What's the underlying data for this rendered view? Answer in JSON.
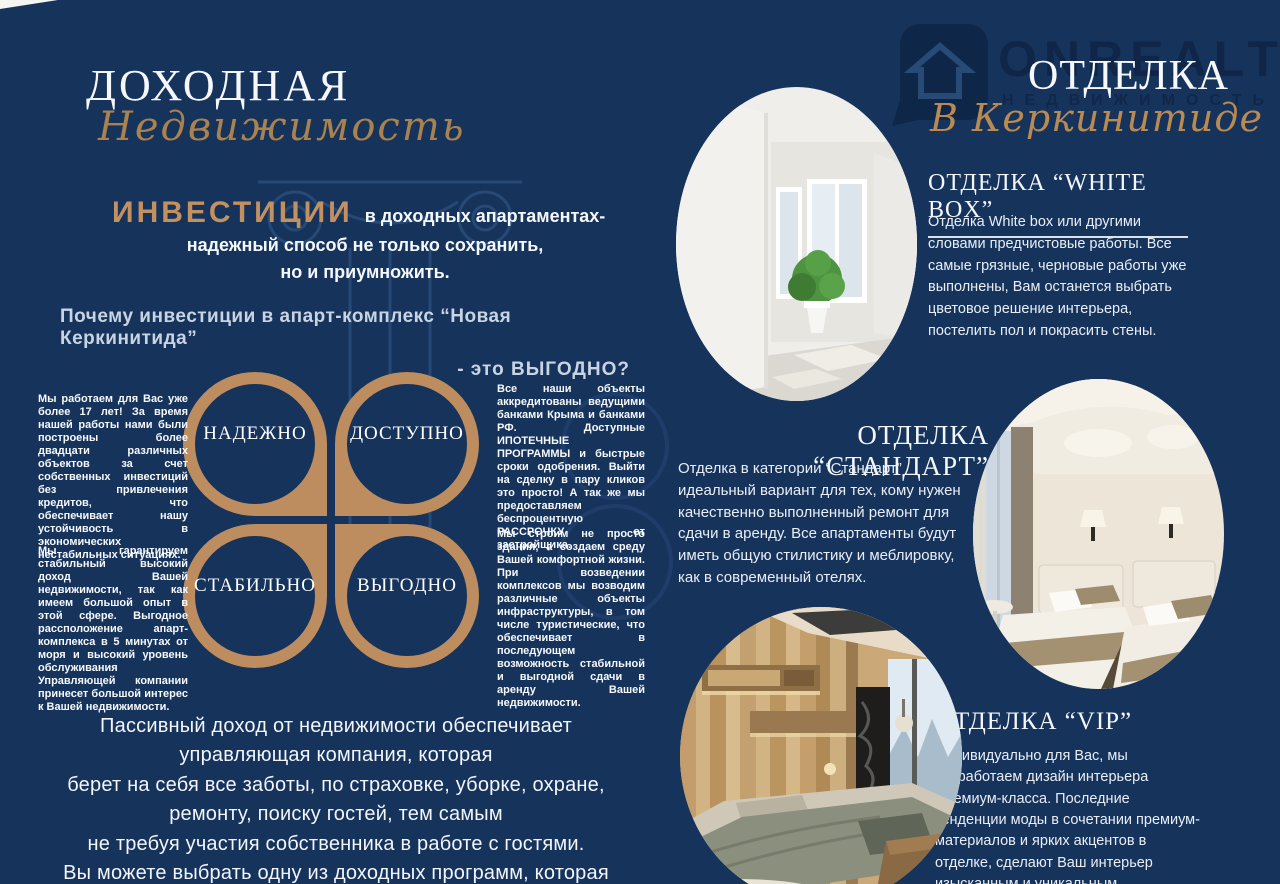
{
  "colors": {
    "background": "#16335c",
    "gold": "#bd8d5f",
    "script_gold": "#a9824f",
    "heading_muted": "#c9d4e2",
    "watermark_navy": "#0e2445"
  },
  "left_page": {
    "title": "ДОХОДНАЯ",
    "subtitle_script": "Недвижимость",
    "invest_heading": "ИНВЕСТИЦИИ",
    "invest_tail": "в доходных апартаментах-",
    "invest_sub": "надежный способ не только сохранить,\nно и приумножить.",
    "why_line1": "Почему инвестиции в апарт-комплекс “Новая Керкинитида”",
    "why_line2": "- это ВЫГОДНО?",
    "benefits": [
      {
        "label": "НАДЕЖНО"
      },
      {
        "label": "ДОСТУПНО"
      },
      {
        "label": "СТАБИЛЬНО"
      },
      {
        "label": "ВЫГОДНО"
      }
    ],
    "col_left_1": "Мы работаем для Вас уже более 17 лет! За время нашей работы нами были построены более двадцати различных объектов за счет собственных инвестиций без привлечения кредитов, что обеспечивает нашу устойчивость в экономических нестабильных ситуациях.",
    "col_left_2": "Мы гарантируем стабильный высокий доход Вашей недвижимости, так как имеем большой опыт в этой сфере. Выгодное рассположение апарт-комплекса в 5 минутах от моря и высокий уровень обслуживания Управляющей компании принесет большой интерес к Вашей недвижимости.",
    "col_right_1": "Все наши объекты аккредитованы ведущими банками Крыма и банками РФ. Доступные ИПОТЕЧНЫЕ ПРОГРАММЫ и быстрые сроки одобрения. Выйти на сделку в пару кликов это просто! А так же мы предоставляем беспроцентную РАССРОЧКУ от застройщика.",
    "col_right_2": "Мы строим не просто здания, а создаем среду Вашей комфортной жизни. При возведении комплексов мы возводим различные объекты инфраструктуры, в том числе туристические, что обеспечивает в последующем возможность стабильной и выгодной сдачи в аренду Вашей недвижимости.",
    "footer": "Пассивный доход от недвижимости обеспечивает\nуправляющая компания,  которая\nберет на себя все заботы, по страховке, уборке, охране,\nремонту, поиску гостей, тем самым\nне требуя участия собственника в работе с гостями.\nВы можете выбрать одну из доходных программ, которая\nВам больше подходит."
  },
  "right_page": {
    "watermark": {
      "brand": "ONREALT",
      "sub": "НЕДВИЖИМОСТЬ"
    },
    "page_title": "ОТДЕЛКА",
    "page_subtitle_script": "В Керкинитиде",
    "sections": [
      {
        "heading": "ОТДЕЛКА  “WHITE BOX”",
        "body": "Отделка White box или другими словами предчистовые работы. Все самые грязные, черновые работы уже выполнены, Вам останется выбрать цветовое решение интерьера, постелить пол и покрасить стены.",
        "photo": "empty-white-room-with-plant"
      },
      {
        "heading": "ОТДЕЛКА “СТАНДАРТ”",
        "body": "Отделка в категории “Стандарт” идеальный вариант для тех, кому нужен качественно выполненный ремонт для сдачи в аренду. Все апартаменты будут иметь общую стилистику и меблировку, как в современный отелях.",
        "photo": "hotel-twin-beds-room"
      },
      {
        "heading": "ОТДЕЛКА “VIP”",
        "body": "Индивидуально для Вас, мы разработаем дизайн интерьера Премиум-класса. Последние тенденции моды в сочетании премиум-материалов и ярких акцентов в отделке, сделают Ваш интерьер изысканным и уникальным.",
        "photo": "premium-wood-bedroom"
      }
    ]
  }
}
